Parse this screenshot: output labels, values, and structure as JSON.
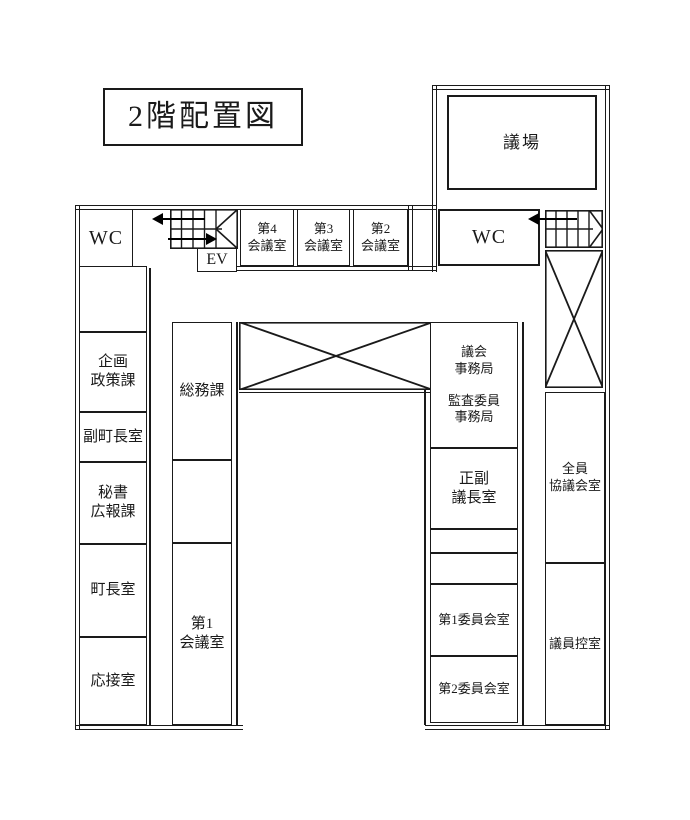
{
  "title": "2階配置図",
  "colors": {
    "line": "#1a1a1a",
    "background": "#ffffff"
  },
  "rooms": {
    "gijo": "議場",
    "wc_left": "WC",
    "wc_right": "WC",
    "ev": "EV",
    "meeting4": "第4\n会議室",
    "meeting3": "第3\n会議室",
    "meeting2": "第2\n会議室",
    "kikaku_seisaku": "企画\n政策課",
    "fuku_chocho": "副町長室",
    "hisho_koho": "秘書\n広報課",
    "chocho": "町長室",
    "osetsu": "応接室",
    "somu": "総務課",
    "meeting1": "第1\n会議室",
    "gikai_jimukyoku": "議会\n事務局\n\n監査委員\n事務局",
    "seifuku_gicho": "正副\n議長室",
    "iinkai1": "第1委員会室",
    "iinkai2": "第2委員会室",
    "zenin_kyogikai": "全員\n協議会室",
    "giin_hikae": "議員控室"
  }
}
